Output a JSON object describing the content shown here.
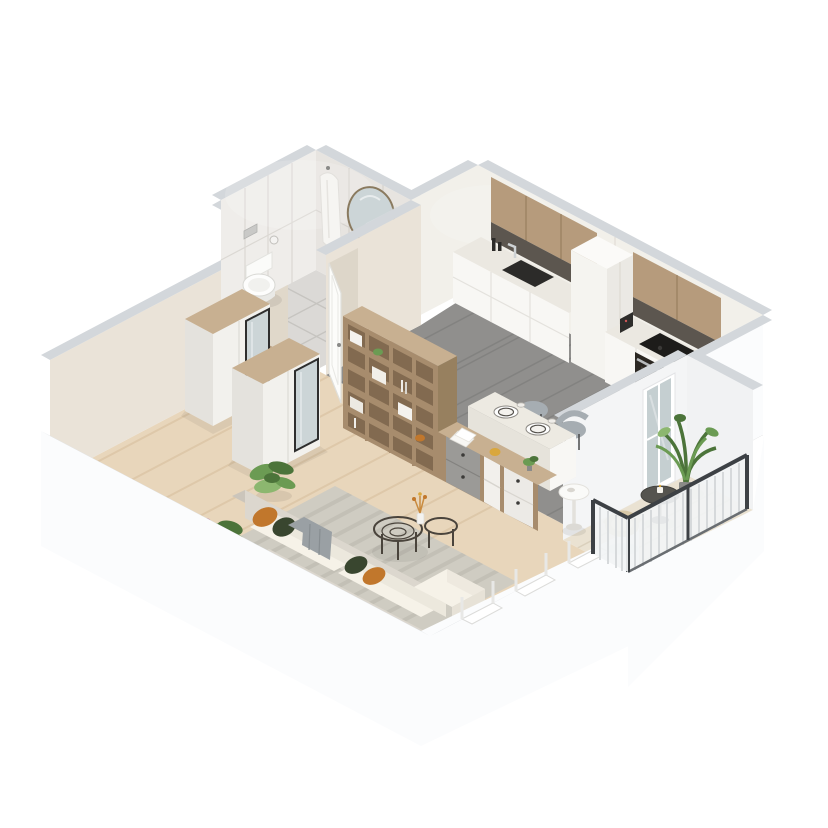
{
  "meta": {
    "description": "Isometric 3D cutaway render of a one-bedroom apartment floor plan on a white background",
    "view": "isometric top-down cutaway",
    "background": "#ffffff"
  },
  "colors": {
    "bg": "#ffffff",
    "wallTop": "#d3d7db",
    "wallOuter": "#fbfcfd",
    "wallOuterShade": "#f3f4f6",
    "innerBeige": "#eae3d8",
    "innerBeigeDark": "#e0d8ca",
    "innerLight": "#f2f0ea",
    "bathTile": "#efedea",
    "bathTileShade": "#e7e4e0",
    "bathFloor": "#dbd9d6",
    "woodFloor": "#e8d6bb",
    "woodStreak": "#d5bd9c",
    "tileFloor": "#908f8d",
    "tileLine": "#7b7a78",
    "balconyFloor": "#eae2d2",
    "wood": "#b69b7c",
    "woodLight": "#c8b091",
    "woodDark": "#97805f",
    "shelfWood": "#a78c6d",
    "shelfCell": "#826a50",
    "drawerGray": "#9b9a97",
    "counter": "#ebe8e1",
    "facade": "#f8f7f4",
    "facadeShade": "#e9e7e2",
    "dark": "#2c2b29",
    "steel": "#b9bcbe",
    "chrome": "#ced2d4",
    "vanityDark": "#55504a",
    "sofa": "#dcd7ce",
    "sofaShade": "#cbc5bb",
    "cushion": "#f6f2e8",
    "pillowOrange": "#c1772c",
    "pillowGreen": "#39462f",
    "throwGray": "#9aa0a4",
    "rug": "#cfccc2",
    "rugStripe": "#bdbab0",
    "chairGray": "#a6adb2",
    "glass": "#c5cfd1",
    "mirrorGlass": "#ccd5d7",
    "frameDark": "#2e2e2e",
    "plant": "#6b9b53",
    "plantDark": "#4c743a",
    "plantLight": "#8cb76f",
    "pink": "#c995a8",
    "railLight": "#f2f4f5",
    "railDark": "#3d4145",
    "tan": "#d9c9a7",
    "yellow": "#d9a73c"
  },
  "rooms": {
    "entry_hall": {
      "label": "Entry hall",
      "floor": "light oak planks",
      "items": [
        "wardrobe with mirror",
        "second wardrobe with mirror",
        "wooden entry door",
        "open white door",
        "floor plant"
      ]
    },
    "bathroom": {
      "label": "Bathroom",
      "floor": "large light tiles",
      "walls": "marble tiles",
      "items": [
        "wall-hung toilet",
        "flush plate",
        "toilet paper holder",
        "hanging bathrobe towel",
        "round mirror",
        "vanity with sink",
        "shower glass screen",
        "chrome shower column"
      ]
    },
    "kitchen": {
      "label": "Kitchen",
      "floor": "large gray tiles",
      "items": [
        "wood upper cabinets",
        "sink base run with dark sink and faucet",
        "bottles",
        "tall white cabinet",
        "cooktop base run",
        "black induction hob",
        "built-in oven",
        "coffee machine"
      ]
    },
    "dining": {
      "label": "Dining area",
      "items": [
        "white box dining table",
        "two plates with dark rims",
        "cups",
        "two gray chairs"
      ]
    },
    "living": {
      "label": "Living area",
      "floor": "light oak planks",
      "items": [
        "tall open shelving divider with boxes and books",
        "sideboard desk with gray and white drawers",
        "papers",
        "small plant",
        "round white side table",
        "striped gray rug",
        "nesting wire coffee tables",
        "vase with dried flowers",
        "light sofa with white cushions",
        "orange pillows",
        "dark green pillows",
        "gray throw",
        "chaise ottoman",
        "corner plant"
      ]
    },
    "balcony": {
      "label": "Balcony",
      "floor": "pale decking",
      "items": [
        "white slat railing with dark rails",
        "glazed balcony door",
        "tall potted plant",
        "round dark tray table with candle",
        "wicker chair"
      ]
    }
  }
}
